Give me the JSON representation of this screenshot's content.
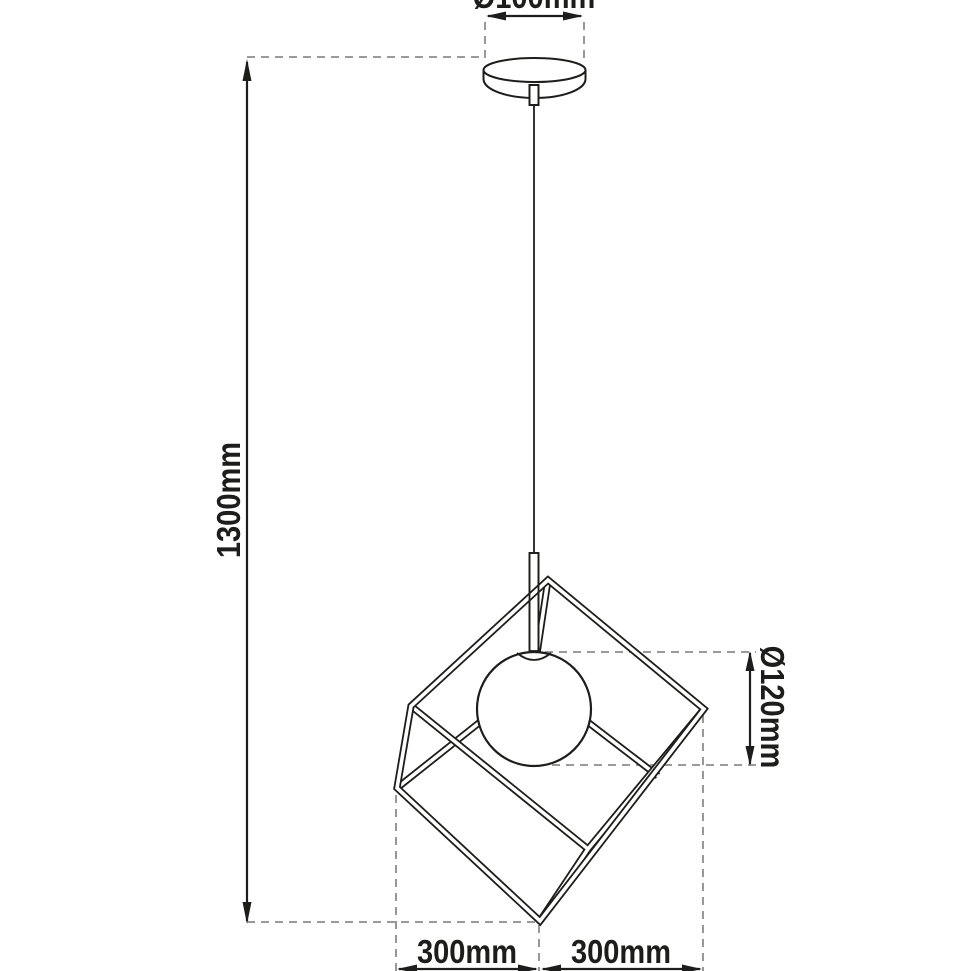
{
  "diagram": {
    "kind": "pendant-lamp-dimension-drawing",
    "background": "#ffffff",
    "line_color": "#1d1d1b",
    "dash_color": "#8c8c8c",
    "labels": {
      "canopy_diameter": "Ø100mm",
      "suspension_height": "1300mm",
      "globe_diameter": "Ø120mm",
      "cage_width_left": "300mm",
      "cage_width_right": "300mm"
    }
  }
}
